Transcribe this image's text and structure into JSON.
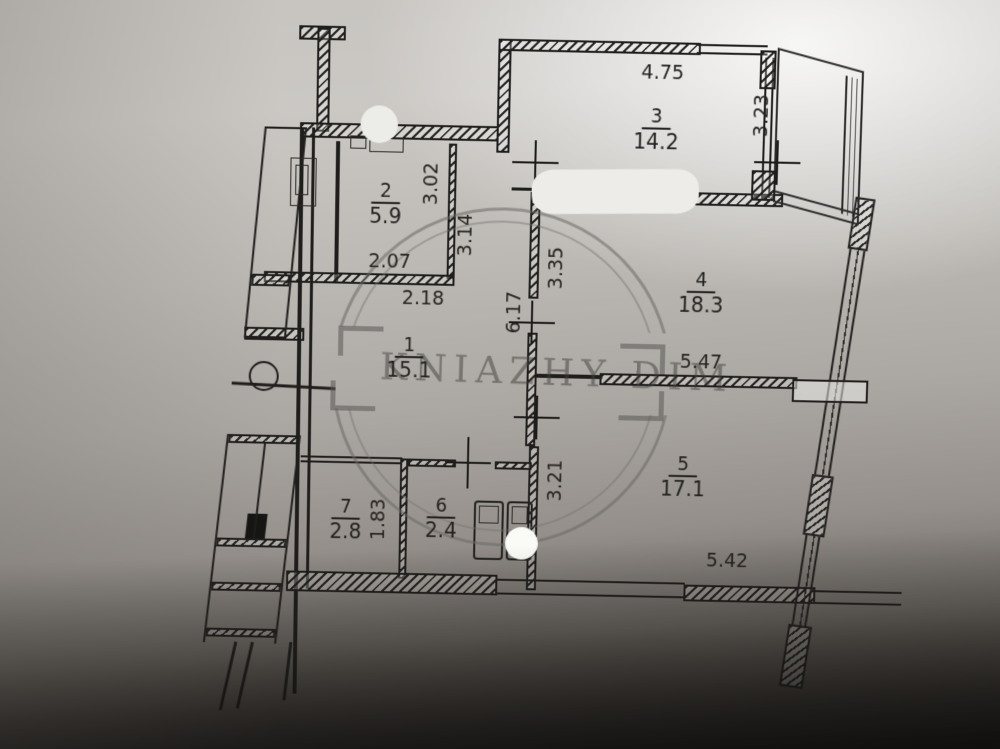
{
  "watermark": {
    "text": "KNIAZHY DIM"
  },
  "rooms": [
    {
      "number": "1",
      "area": "15.1"
    },
    {
      "number": "2",
      "area": "5.9"
    },
    {
      "number": "3",
      "area": "14.2"
    },
    {
      "number": "4",
      "area": "18.3"
    },
    {
      "number": "5",
      "area": "17.1"
    },
    {
      "number": "6",
      "area": "2.4"
    },
    {
      "number": "7",
      "area": "2.8"
    }
  ],
  "dimensions": [
    {
      "value": "4.75",
      "orientation": "horizontal"
    },
    {
      "value": "3.23",
      "orientation": "vertical"
    },
    {
      "value": "3.02",
      "orientation": "vertical"
    },
    {
      "value": "3.14",
      "orientation": "vertical"
    },
    {
      "value": "2.07",
      "orientation": "horizontal"
    },
    {
      "value": "2.18",
      "orientation": "horizontal"
    },
    {
      "value": "3.35",
      "orientation": "vertical"
    },
    {
      "value": "6.17",
      "orientation": "vertical"
    },
    {
      "value": "5.47",
      "orientation": "horizontal"
    },
    {
      "value": "3.21",
      "orientation": "vertical"
    },
    {
      "value": "1.83",
      "orientation": "vertical"
    },
    {
      "value": "5.42",
      "orientation": "horizontal"
    }
  ]
}
